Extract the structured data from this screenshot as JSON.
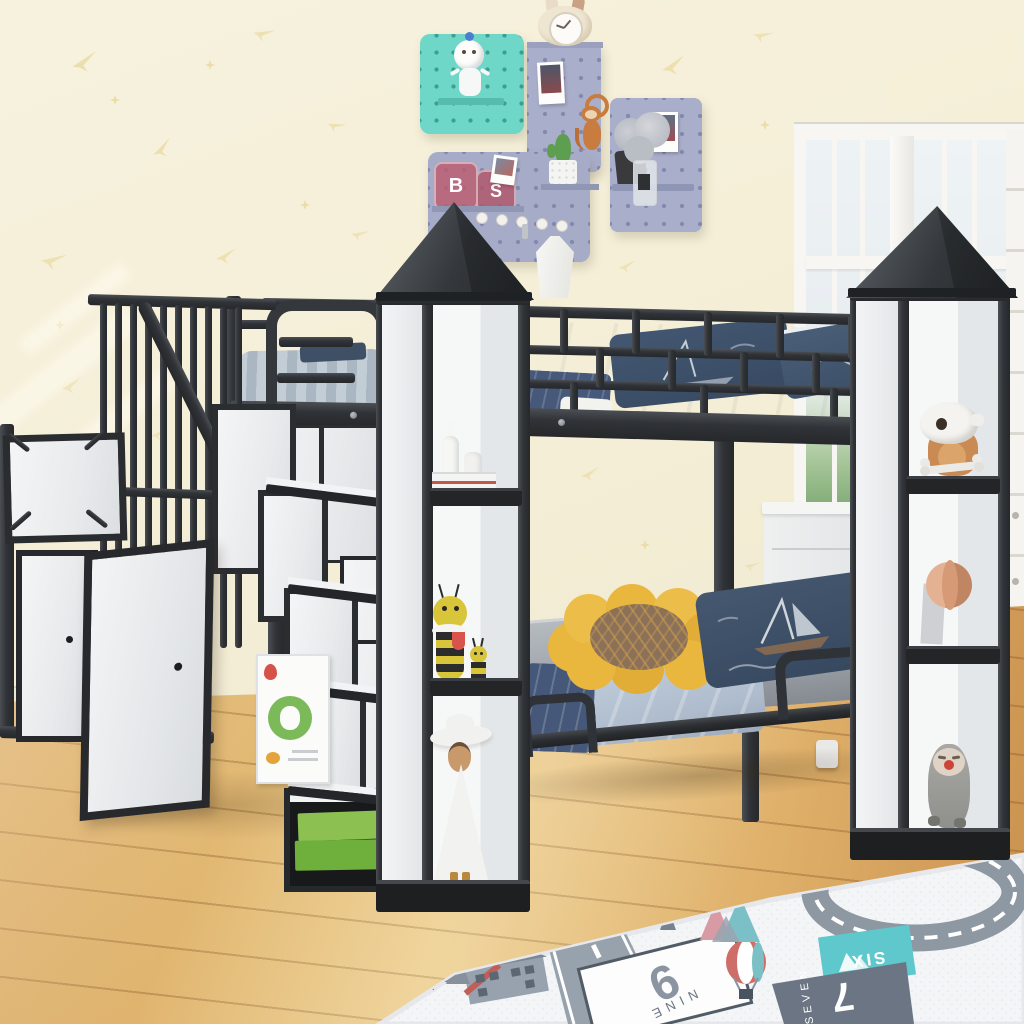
{
  "scene": {
    "description": "Children's bedroom with a black metal castle-style twin-over-twin bunk bed with storage staircase, two shelf towers with pyramid roofs, pegboard wall decor, window and road-map play rug"
  },
  "rug": {
    "numeral_nine": "9",
    "word_nine": "NINE",
    "word_six": "SIX",
    "numeral_seven": "7",
    "word_seven": "SEVEN"
  },
  "decor": {
    "jar_letter_b": "B",
    "jar_letter_s": "S"
  },
  "colors": {
    "wall": "#f5efd9",
    "wallpaper_motif": "#ead9a0",
    "metal_frame": "#2f3236",
    "white_panel": "#eef0f2",
    "tower_roof": "#3a3e41",
    "wood_floor": "#deac64",
    "rug_base": "#f3f4f6",
    "rug_road": "#97a2ad",
    "rug_teal_tile": "#5fc8cc",
    "navy_pillow": "#3d5068",
    "blanket_blue": "#b7c5d6",
    "mattress_gray": "#a3a8ae",
    "flower_pillow": "#e9b63e",
    "storage_box_green": "#7cb445",
    "pegboard_teal": "#6fd7c7",
    "pegboard_lavender": "#a9aecb"
  }
}
